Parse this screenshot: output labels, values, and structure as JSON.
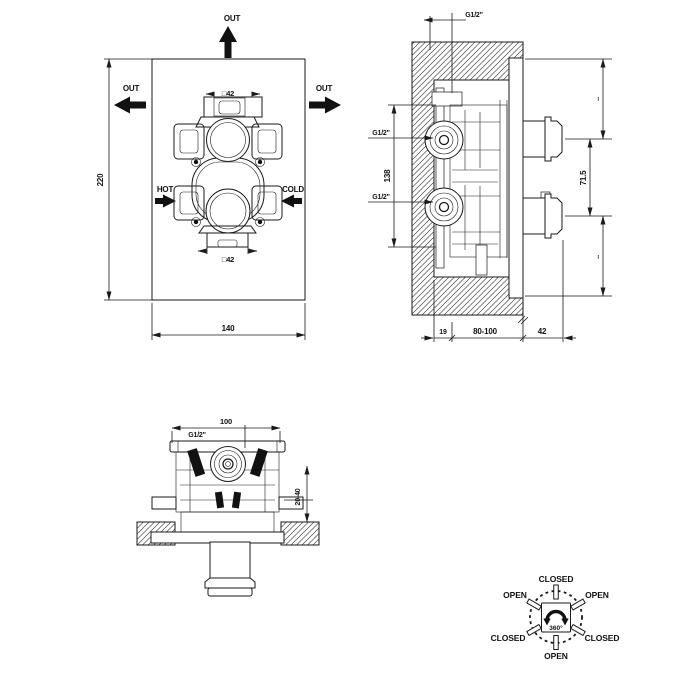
{
  "colors": {
    "line": "#1a1a1a",
    "background": "#ffffff"
  },
  "front_view": {
    "out_top": "OUT",
    "out_left": "OUT",
    "out_right": "OUT",
    "hot": "HOT",
    "cold": "COLD",
    "dim_height": "220",
    "dim_width": "140",
    "dim_square_top": "□42",
    "dim_square_bottom": "□42"
  },
  "side_view": {
    "dim_thread_top": "G1/2\"",
    "dim_thread_upper": "G1/2\"",
    "dim_thread_lower": "G1/2\"",
    "dim_span": "138",
    "dim_handle_gap": "71.5",
    "dim_equal_top": "..",
    "dim_equal_bottom": "..",
    "dim_wall_min": "19",
    "dim_recess_range": "80-100",
    "dim_protrusion": "42"
  },
  "top_view": {
    "dim_thread": "G1/2\"",
    "dim_width": "100",
    "dim_adjust_range": "20-40"
  },
  "rotation_diagram": {
    "rotation": "360°",
    "pos_top": "CLOSED",
    "pos_top_left": "OPEN",
    "pos_top_right": "OPEN",
    "pos_bottom_left": "CLOSED",
    "pos_bottom_right": "CLOSED",
    "pos_bottom": "OPEN"
  }
}
